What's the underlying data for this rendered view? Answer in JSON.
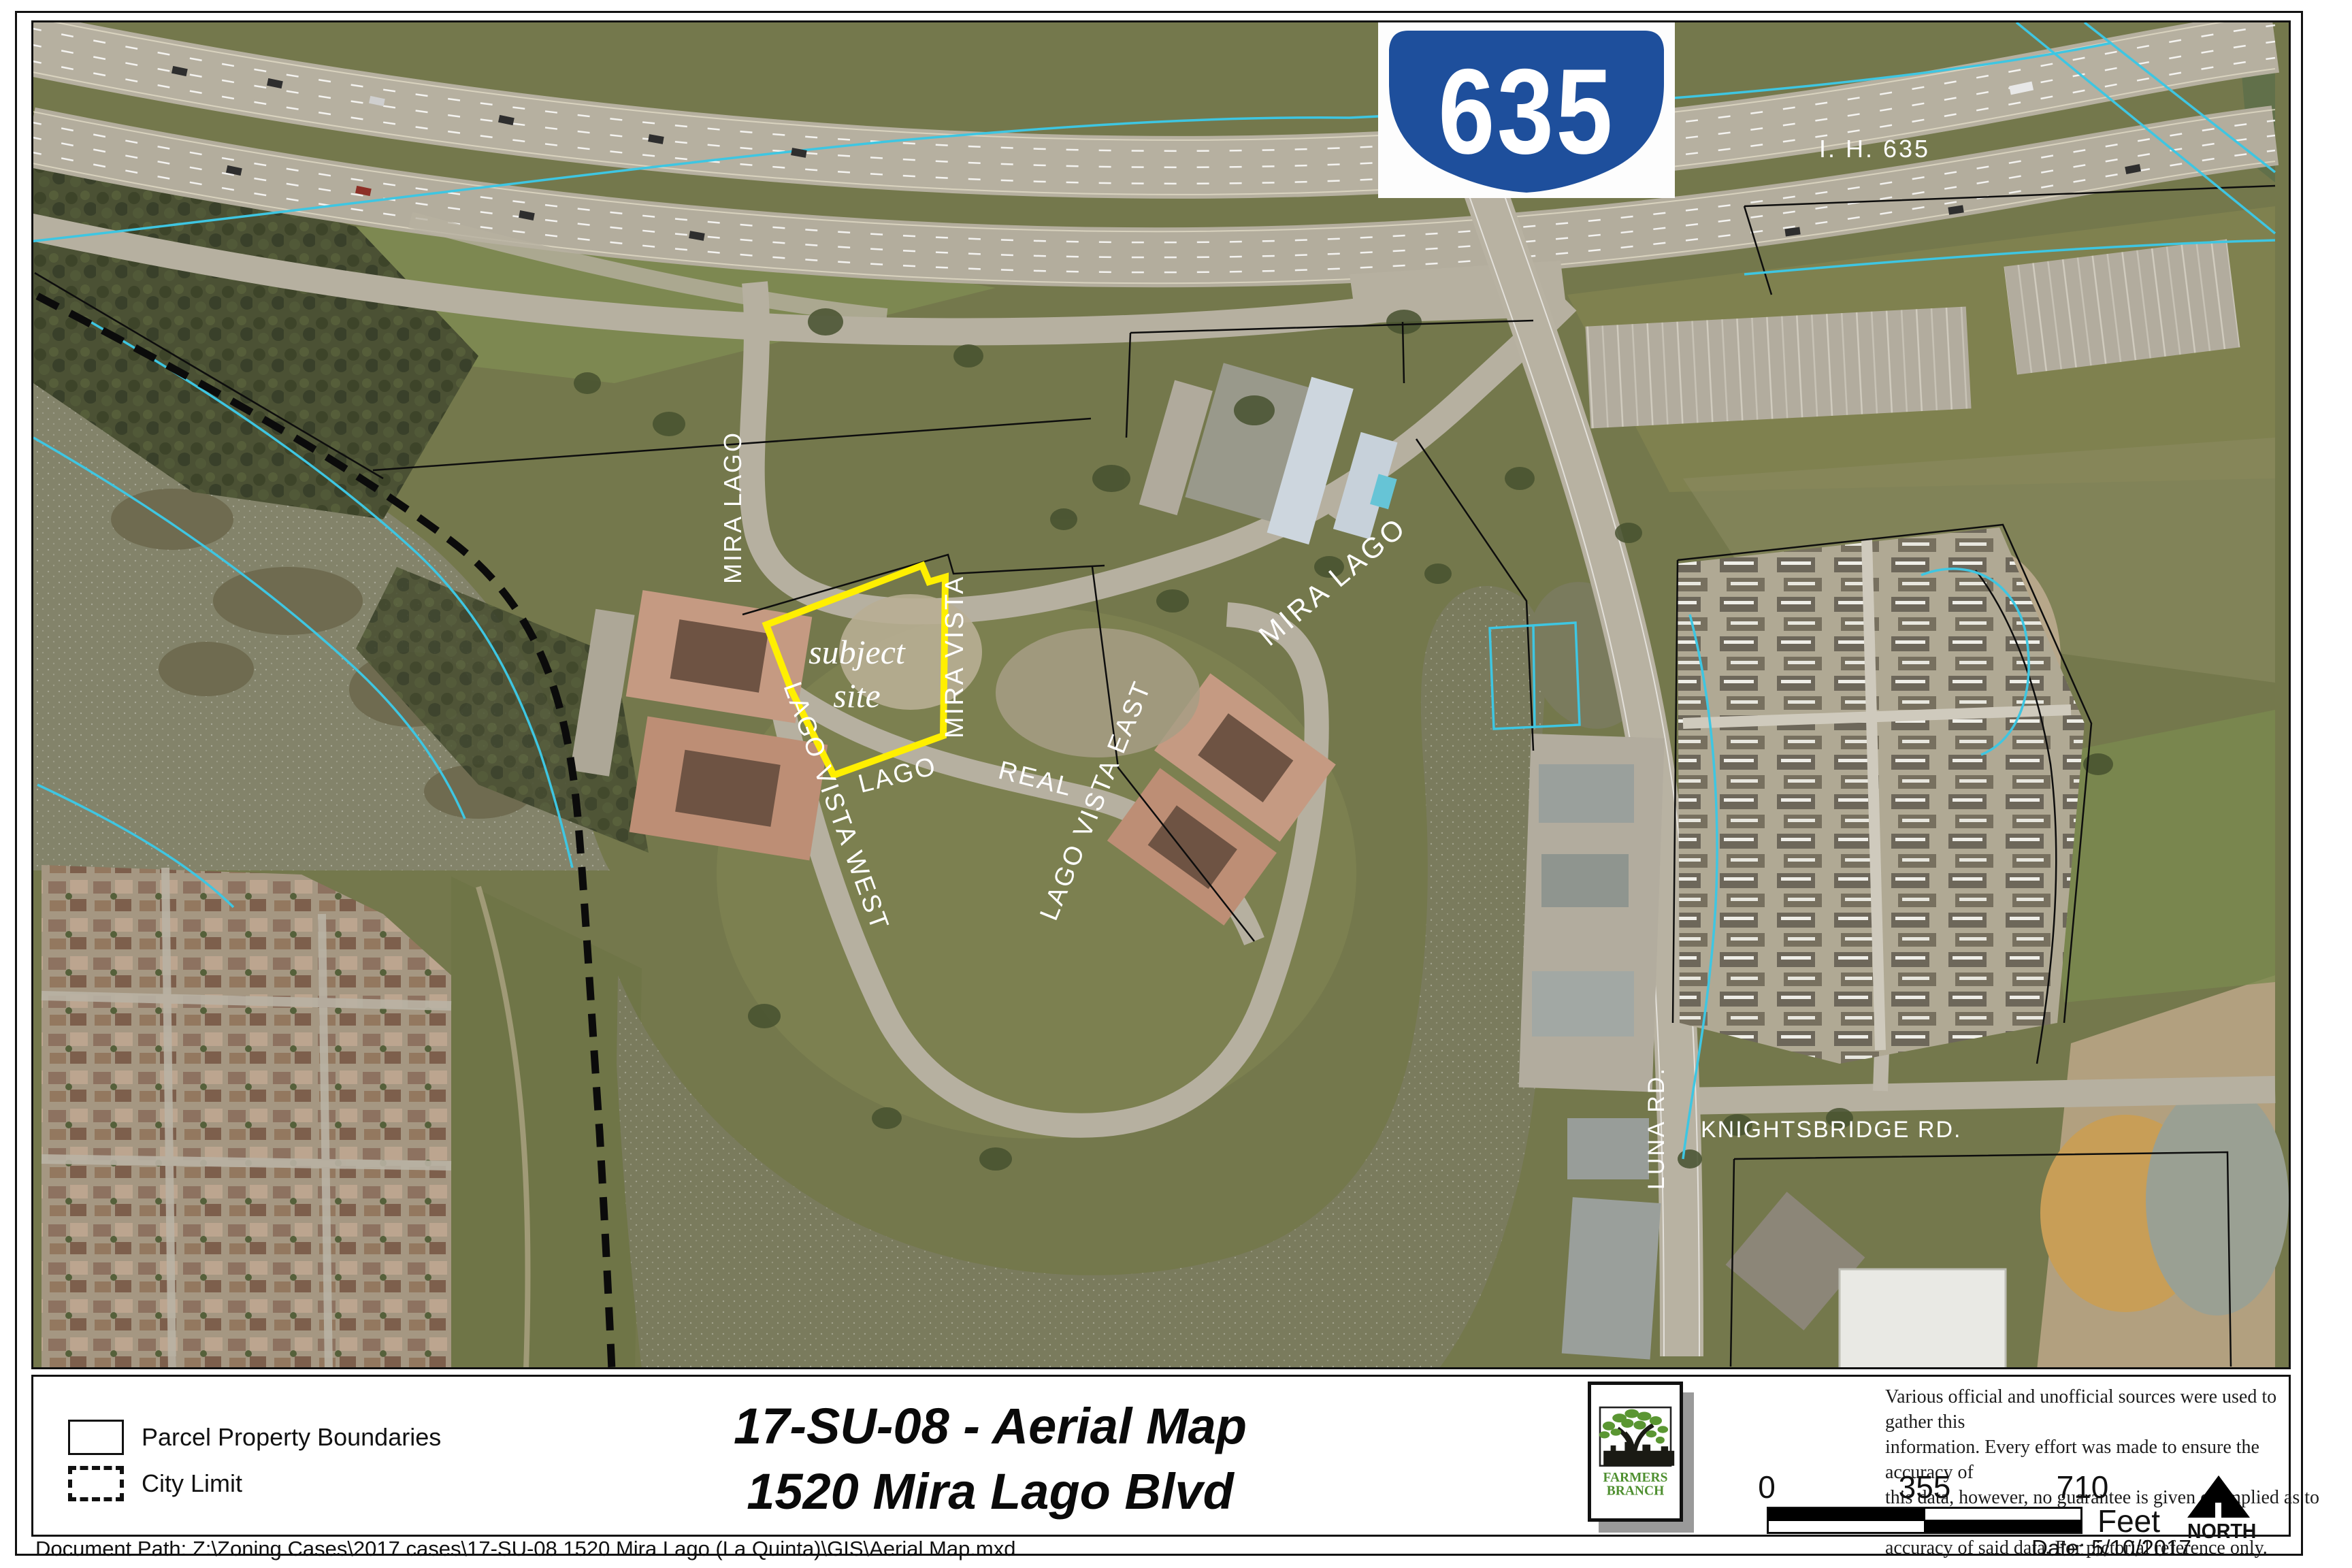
{
  "map": {
    "shield_number": "635",
    "labels": {
      "ih635": "I. H. 635",
      "mira_lago_west": "MIRA LAGO",
      "mira_lago_east": "MIRA LAGO",
      "mira_vista": "MIRA VISTA",
      "subject_line1": "subject",
      "subject_line2": "site",
      "lago": "LAGO",
      "real": "REAL",
      "lago_vista_west": "LAGO VISTA WEST",
      "lago_vista_east": "LAGO VISTA EAST",
      "luna_rd": "LUNA RD.",
      "knightsbridge_rd": "KNIGHTSBRIDGE RD."
    }
  },
  "legend": {
    "items": [
      {
        "label": "Parcel Property Boundaries"
      },
      {
        "label": "City Limit"
      }
    ]
  },
  "title": {
    "line1": "17-SU-08 -  Aerial Map",
    "line2": "1520 Mira Lago Blvd"
  },
  "logo": {
    "line1": "FARMERS",
    "line2": "BRANCH"
  },
  "disclaimer": {
    "lines": [
      "Various official and unofficial sources were used to gather this",
      "information. Every effort was made to ensure the accuracy of",
      "this data, however, no guarantee is given or implied as to the",
      "accuracy of said data.  For pictorial reference only."
    ]
  },
  "scalebar": {
    "ticks": [
      "0",
      "355",
      "710"
    ],
    "unit": "Feet"
  },
  "north_arrow": {
    "label": "NORTH"
  },
  "footer": {
    "document_path": "Document Path: Z:\\Zoning Cases\\2017 cases\\17-SU-08 1520 Mira Lago (La Quinta)\\GIS\\Aerial Map.mxd",
    "date": "Date: 5/10/2017"
  },
  "colors": {
    "subject_site_outline": "#ffef00",
    "city_limit_line": "#000000",
    "hydro_line": "#3ec6e2",
    "shield_blue": "#1e4f9c",
    "logo_green": "#4e8f2f"
  }
}
